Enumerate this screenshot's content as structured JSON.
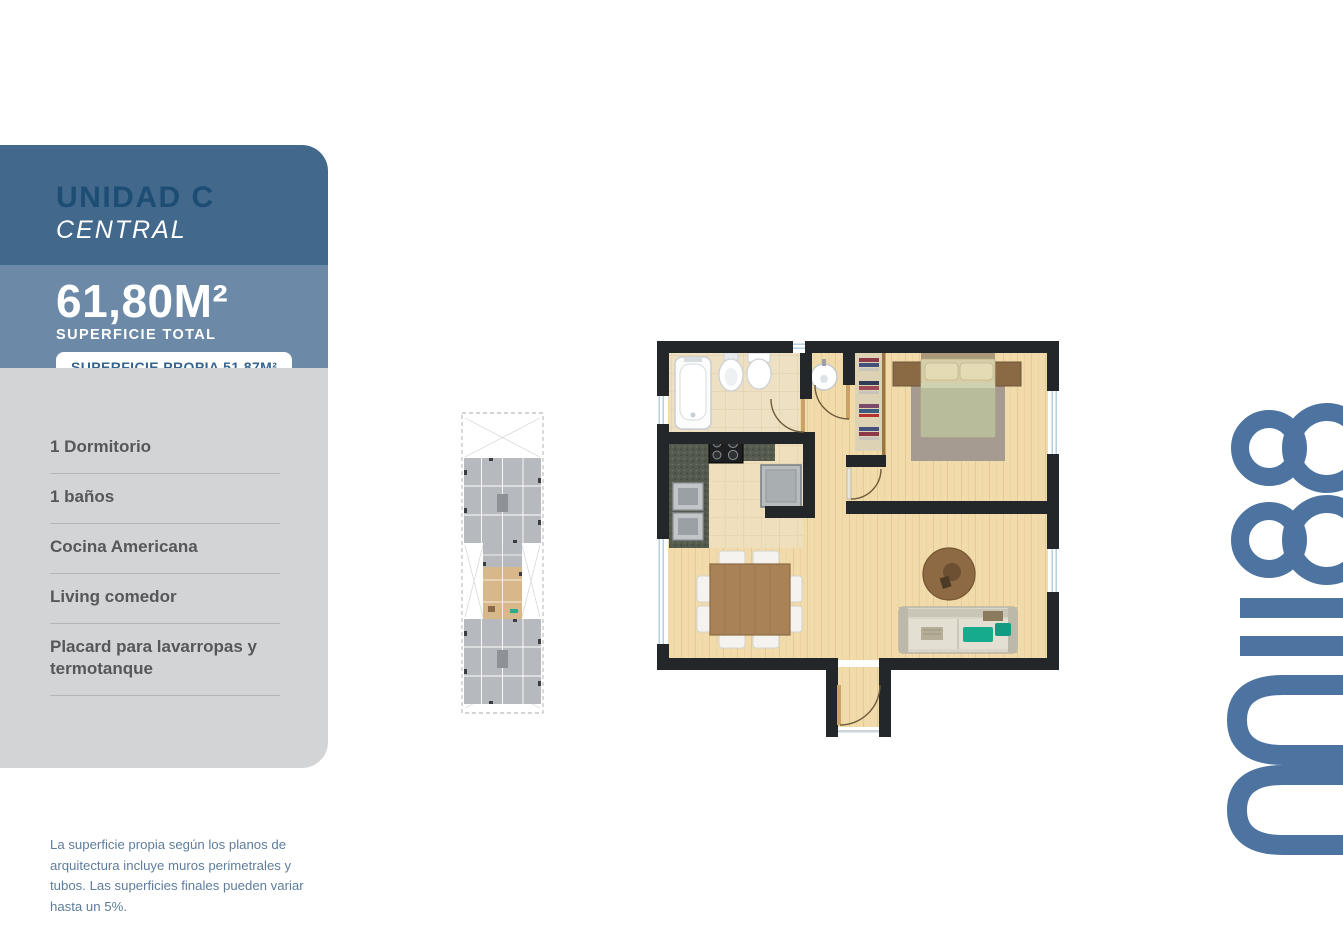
{
  "page": {
    "background": "#FFFFFF"
  },
  "brand": {
    "logo_text": "mii88",
    "logo_color": "#4D74A1"
  },
  "unit_card": {
    "title": "UNIDAD C",
    "subtitle": "CENTRAL",
    "area_total_value": "61,80M²",
    "area_total_label": "SUPERFICIE TOTAL",
    "own_area_badge": "SUPERFICIE PROPIA 51,87M²",
    "features": [
      "1 Dormitorio",
      "1 baños",
      "Cocina Americana",
      "Living comedor",
      "Placard para lavarropas y termotanque"
    ],
    "colors": {
      "header_bg": "#42688C",
      "band_bg": "#6C8AA7",
      "body_bg": "#D2D4D6",
      "title_text": "#1D4D73",
      "subtitle_text": "#FFFFFF",
      "badge_bg": "#FFFFFF",
      "badge_text": "#36648E",
      "feature_text": "#55585A",
      "divider": "#B4B7BA"
    }
  },
  "locator_plan": {
    "highlighted_unit_color": "#D8B78A",
    "units_color": "#B6B9BD"
  },
  "floor_plan": {
    "wall_color": "#23272A",
    "wood_floor_color": "#F1DBAA",
    "accent_cushion_color": "#17AB8E"
  },
  "disclaimer": {
    "text": "La superficie propia según los planos de arquitectura incluye muros perimetrales y tubos. Las superficies finales pueden variar hasta un 5%."
  }
}
